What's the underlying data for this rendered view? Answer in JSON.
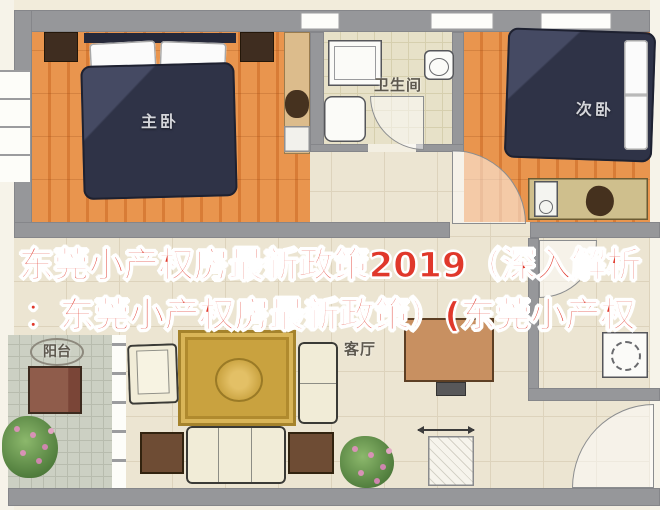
{
  "overlay": {
    "line1": "东莞小产权房最新政策2019（深入解析",
    "line2": "：东莞小产权房最新政策）(东莞小产权",
    "text_color": "#e0382b",
    "outline_color": "#ffffff"
  },
  "floorplan": {
    "rooms": {
      "master_bedroom": {
        "label": "主卧"
      },
      "second_bedroom": {
        "label": "次卧"
      },
      "bathroom": {
        "label": "卫生间"
      },
      "living_room": {
        "label": "客厅"
      },
      "balcony": {
        "label": "阳台"
      }
    },
    "colors": {
      "wood_floor": "#e18a45",
      "bed_cover": "#2f3347",
      "cream_tile": "#ece5d2",
      "bath_tile": "#e7e1c8",
      "balcony_tile": "#ccd0c3",
      "wall_gray": "#96979a",
      "rug_gold": "#c9a23f",
      "sofa_cream": "#f1ecd7",
      "overlay_red": "#e0382b"
    }
  }
}
